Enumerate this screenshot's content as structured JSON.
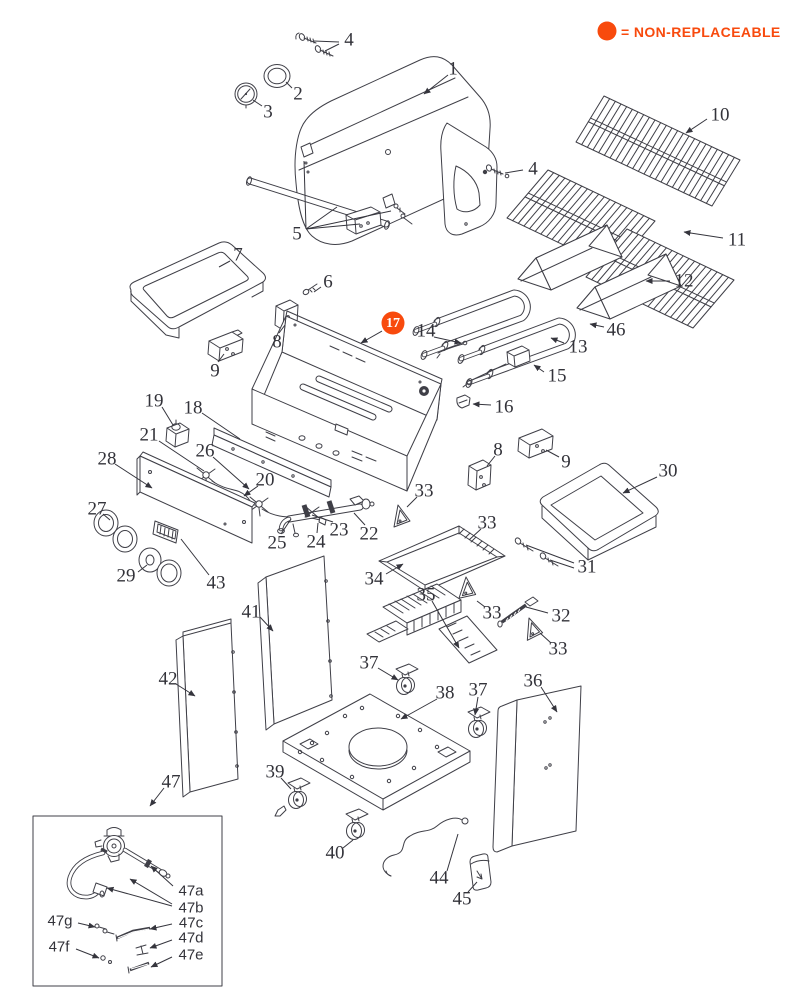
{
  "legend": {
    "text": "= NON-REPLACEABLE",
    "color": "#F84A0D",
    "dot": {
      "cx": 607,
      "cy": 31,
      "r": 9.5
    }
  },
  "colors": {
    "line": "#3f3f47",
    "label": "#33333a",
    "highlight": "#F84A0D",
    "badge_text": "#ffffff"
  },
  "diagram": {
    "highlighted_part": {
      "text": "17",
      "x": 393,
      "y": 323,
      "r": 11.5,
      "leader": [
        382,
        331,
        361,
        343
      ],
      "arrow": true
    },
    "part_labels": [
      {
        "text": "4",
        "x": 349,
        "y": 40,
        "leaders": [
          [
            339,
            42,
            314,
            41
          ],
          [
            339,
            44,
            325,
            51
          ]
        ],
        "arrow": false
      },
      {
        "text": "2",
        "x": 298,
        "y": 94,
        "leaders": [
          [
            292,
            88,
            286,
            82
          ]
        ],
        "arrow": false
      },
      {
        "text": "3",
        "x": 268,
        "y": 112,
        "leaders": [
          [
            262,
            106,
            253,
            100
          ]
        ],
        "arrow": false
      },
      {
        "text": "1",
        "x": 453,
        "y": 69,
        "leaders": [
          [
            448,
            75,
            424,
            94
          ]
        ],
        "arrow": true
      },
      {
        "text": "4",
        "x": 533,
        "y": 169,
        "leaders": [
          [
            523,
            170,
            505,
            173
          ]
        ],
        "arrow": false
      },
      {
        "text": "5",
        "x": 297,
        "y": 234,
        "leaders": [
          [
            306,
            229,
            304,
            161
          ],
          [
            306,
            229,
            337,
            207
          ],
          [
            306,
            229,
            360,
            224
          ],
          [
            306,
            229,
            391,
            211
          ]
        ],
        "arrow": false
      },
      {
        "text": "10",
        "x": 720,
        "y": 115,
        "leaders": [
          [
            707,
            119,
            686,
            133
          ]
        ],
        "arrow": true
      },
      {
        "text": "11",
        "x": 737,
        "y": 240,
        "leaders": [
          [
            723,
            238,
            684,
            232
          ]
        ],
        "arrow": true
      },
      {
        "text": "12",
        "x": 684,
        "y": 281,
        "leaders": [
          [
            670,
            281,
            646,
            281
          ]
        ],
        "arrow": true
      },
      {
        "text": "13",
        "x": 578,
        "y": 347,
        "leaders": [
          [
            564,
            343,
            551,
            338
          ]
        ],
        "arrow": true
      },
      {
        "text": "14",
        "x": 426,
        "y": 331,
        "leaders": [
          [
            434,
            337,
            461,
            343
          ]
        ],
        "arrow": true
      },
      {
        "text": "46",
        "x": 616,
        "y": 330,
        "leaders": [
          [
            604,
            327,
            590,
            324
          ]
        ],
        "arrow": true
      },
      {
        "text": "15",
        "x": 557,
        "y": 376,
        "leaders": [
          [
            544,
            372,
            534,
            365
          ]
        ],
        "arrow": true
      },
      {
        "text": "16",
        "x": 504,
        "y": 407,
        "leaders": [
          [
            491,
            405,
            473,
            404
          ]
        ],
        "arrow": true
      },
      {
        "text": "6",
        "x": 328,
        "y": 282,
        "leaders": [
          [
            321,
            287,
            314,
            292
          ]
        ],
        "arrow": false
      },
      {
        "text": "7",
        "x": 238,
        "y": 255,
        "leaders": [
          [
            230,
            261,
            219,
            267
          ]
        ],
        "arrow": false
      },
      {
        "text": "8",
        "x": 277,
        "y": 342,
        "leaders": [
          [
            279,
            333,
            285,
            325
          ]
        ],
        "arrow": false
      },
      {
        "text": "9",
        "x": 215,
        "y": 371,
        "leaders": [
          [
            218,
            362,
            224,
            354
          ]
        ],
        "arrow": false
      },
      {
        "text": "19",
        "x": 154,
        "y": 401,
        "leaders": [
          [
            162,
            407,
            173,
            425
          ]
        ],
        "arrow": false
      },
      {
        "text": "18",
        "x": 193,
        "y": 408,
        "leaders": [
          [
            202,
            413,
            240,
            439
          ]
        ],
        "arrow": false
      },
      {
        "text": "21",
        "x": 149,
        "y": 435,
        "leaders": [
          [
            159,
            441,
            204,
            471
          ]
        ],
        "arrow": false
      },
      {
        "text": "26",
        "x": 205,
        "y": 451,
        "leaders": [
          [
            213,
            457,
            249,
            489
          ]
        ],
        "arrow": true
      },
      {
        "text": "28",
        "x": 107,
        "y": 459,
        "leaders": [
          [
            115,
            464,
            152,
            488
          ]
        ],
        "arrow": true
      },
      {
        "text": "20",
        "x": 265,
        "y": 480,
        "leaders": [
          [
            258,
            486,
            244,
            496
          ]
        ],
        "arrow": true
      },
      {
        "text": "27",
        "x": 97,
        "y": 509,
        "leaders": [
          [
            103,
            514,
            110,
            520
          ]
        ],
        "arrow": false
      },
      {
        "text": "8",
        "x": 498,
        "y": 450,
        "leaders": [
          [
            495,
            456,
            487,
            466
          ]
        ],
        "arrow": false
      },
      {
        "text": "9",
        "x": 566,
        "y": 462,
        "leaders": [
          [
            559,
            457,
            546,
            450
          ]
        ],
        "arrow": false
      },
      {
        "text": "30",
        "x": 668,
        "y": 471,
        "leaders": [
          [
            657,
            477,
            623,
            493
          ]
        ],
        "arrow": true
      },
      {
        "text": "25",
        "x": 277,
        "y": 543,
        "leaders": [
          [
            281,
            534,
            291,
            519
          ]
        ],
        "arrow": false
      },
      {
        "text": "24",
        "x": 316,
        "y": 542,
        "leaders": [
          [
            317,
            533,
            318,
            523
          ]
        ],
        "arrow": false
      },
      {
        "text": "23",
        "x": 339,
        "y": 530,
        "leaders": [
          [
            333,
            522,
            312,
            515
          ]
        ],
        "arrow": false
      },
      {
        "text": "22",
        "x": 369,
        "y": 534,
        "leaders": [
          [
            365,
            525,
            354,
            513
          ]
        ],
        "arrow": false
      },
      {
        "text": "33",
        "x": 424,
        "y": 491,
        "leaders": [
          [
            417,
            497,
            407,
            507
          ]
        ],
        "arrow": false
      },
      {
        "text": "33",
        "x": 487,
        "y": 523,
        "leaders": [
          [
            481,
            529,
            469,
            540
          ]
        ],
        "arrow": false
      },
      {
        "text": "31",
        "x": 587,
        "y": 567,
        "leaders": [
          [
            574,
            563,
            526,
            545
          ],
          [
            574,
            568,
            550,
            560
          ]
        ],
        "arrow": false
      },
      {
        "text": "29",
        "x": 126,
        "y": 576,
        "leaders": [
          [
            138,
            572,
            147,
            565
          ]
        ],
        "arrow": false
      },
      {
        "text": "43",
        "x": 216,
        "y": 583,
        "leaders": [
          [
            209,
            575,
            181,
            539
          ]
        ],
        "arrow": false
      },
      {
        "text": "34",
        "x": 374,
        "y": 579,
        "leaders": [
          [
            386,
            574,
            403,
            564
          ]
        ],
        "arrow": true
      },
      {
        "text": "35",
        "x": 426,
        "y": 595,
        "leaders": [
          [
            432,
            601,
            459,
            648
          ]
        ],
        "arrow": true
      },
      {
        "text": "33",
        "x": 492,
        "y": 613,
        "leaders": [
          [
            485,
            607,
            477,
            601
          ]
        ],
        "arrow": false
      },
      {
        "text": "32",
        "x": 561,
        "y": 616,
        "leaders": [
          [
            548,
            613,
            526,
            607
          ]
        ],
        "arrow": false
      },
      {
        "text": "33",
        "x": 558,
        "y": 649,
        "leaders": [
          [
            551,
            643,
            540,
            633
          ]
        ],
        "arrow": false
      },
      {
        "text": "41",
        "x": 251,
        "y": 612,
        "leaders": [
          [
            260,
            617,
            273,
            631
          ]
        ],
        "arrow": true
      },
      {
        "text": "42",
        "x": 168,
        "y": 679,
        "leaders": [
          [
            176,
            684,
            195,
            696
          ]
        ],
        "arrow": true
      },
      {
        "text": "37",
        "x": 369,
        "y": 663,
        "leaders": [
          [
            378,
            668,
            398,
            680
          ]
        ],
        "arrow": true
      },
      {
        "text": "38",
        "x": 445,
        "y": 693,
        "leaders": [
          [
            437,
            699,
            401,
            719
          ]
        ],
        "arrow": true
      },
      {
        "text": "37",
        "x": 478,
        "y": 690,
        "leaders": [
          [
            478,
            697,
            475,
            715
          ]
        ],
        "arrow": true
      },
      {
        "text": "36",
        "x": 533,
        "y": 681,
        "leaders": [
          [
            541,
            687,
            557,
            712
          ]
        ],
        "arrow": true
      },
      {
        "text": "39",
        "x": 275,
        "y": 772,
        "leaders": [
          [
            281,
            778,
            291,
            789
          ]
        ],
        "arrow": false
      },
      {
        "text": "40",
        "x": 335,
        "y": 853,
        "leaders": [
          [
            343,
            848,
            353,
            840
          ]
        ],
        "arrow": false
      },
      {
        "text": "44",
        "x": 439,
        "y": 878,
        "leaders": [
          [
            447,
            871,
            458,
            834
          ]
        ],
        "arrow": false
      },
      {
        "text": "45",
        "x": 462,
        "y": 899,
        "leaders": [
          [
            468,
            892,
            477,
            882
          ]
        ],
        "arrow": false
      },
      {
        "text": "47",
        "x": 171,
        "y": 782,
        "leaders": [
          [
            164,
            788,
            150,
            806
          ]
        ],
        "arrow": true
      },
      {
        "text": "47a",
        "x": 191,
        "y": 891,
        "font": "sans",
        "leaders": [
          [
            173,
            886,
            151,
            866
          ]
        ],
        "arrow": true
      },
      {
        "text": "47b",
        "x": 191,
        "y": 908,
        "font": "sans",
        "leaders": [
          [
            172,
            904,
            130,
            879
          ],
          [
            172,
            906,
            107,
            888
          ]
        ],
        "arrow": true
      },
      {
        "text": "47g",
        "x": 60,
        "y": 921,
        "font": "sans",
        "leaders": [
          [
            78,
            923,
            95,
            927
          ]
        ],
        "arrow": true
      },
      {
        "text": "47c",
        "x": 191,
        "y": 923,
        "font": "sans",
        "leaders": [
          [
            172,
            924,
            150,
            929
          ]
        ],
        "arrow": true
      },
      {
        "text": "47d",
        "x": 191,
        "y": 938,
        "font": "sans",
        "leaders": [
          [
            172,
            940,
            150,
            948
          ]
        ],
        "arrow": true
      },
      {
        "text": "47f",
        "x": 59,
        "y": 947,
        "font": "sans",
        "leaders": [
          [
            76,
            949,
            99,
            958
          ]
        ],
        "arrow": true
      },
      {
        "text": "47e",
        "x": 191,
        "y": 955,
        "font": "sans",
        "leaders": [
          [
            172,
            957,
            151,
            967
          ]
        ],
        "arrow": true
      }
    ]
  }
}
